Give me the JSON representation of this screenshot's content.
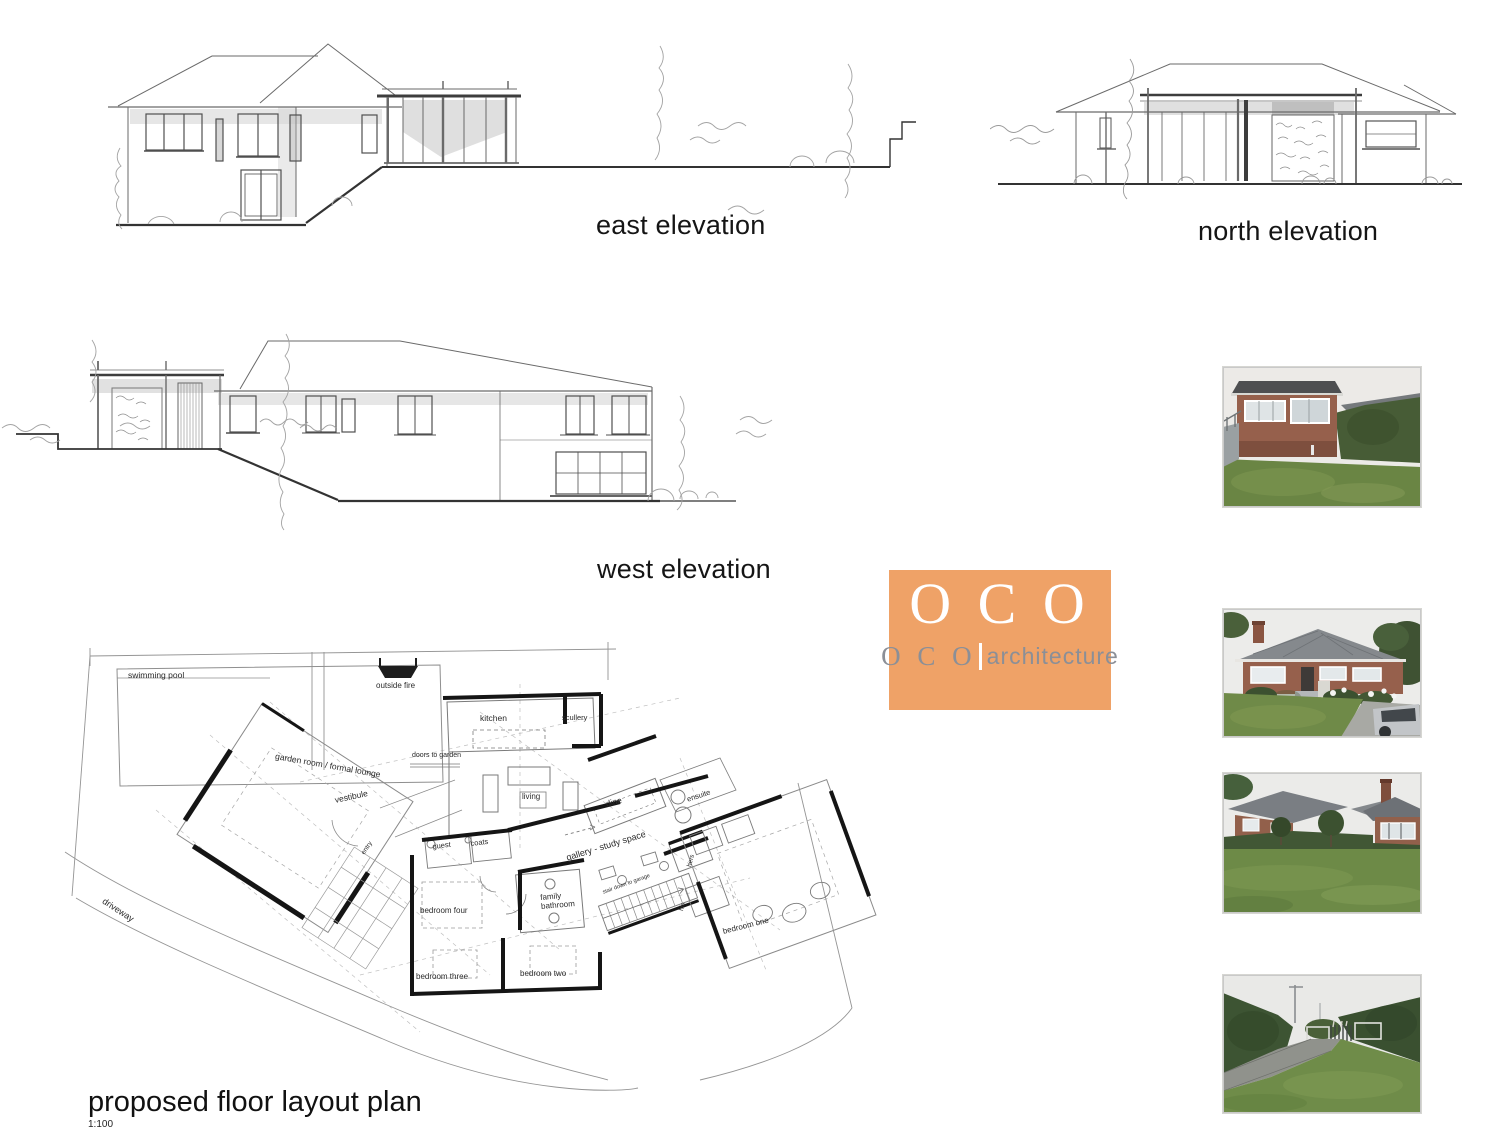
{
  "sheet": {
    "background": "#ffffff"
  },
  "elevations": {
    "east": "east elevation",
    "north": "north elevation",
    "west": "west elevation"
  },
  "logo": {
    "main": "O C O",
    "sub_initials": "O C O",
    "sub_word": "architecture",
    "orange": "#efa267",
    "text_gray": "#8b8f97"
  },
  "plan": {
    "title": "proposed floor layout plan",
    "scale": "1:100",
    "labels": {
      "swimming_pool": "swimming pool",
      "outside_fire": "outside fire",
      "kitchen": "kitchen",
      "scullery": "scullery",
      "garden_room": "garden room / formal lounge",
      "doors_to_garden": "doors to garden",
      "living": "living",
      "dine": "dine",
      "ensuite": "ensuite",
      "vestibule": "vestibule",
      "entry": "entry",
      "guest": "guest",
      "coats": "coats",
      "gallery": "gallery - study space",
      "hers": "hers",
      "his": "his",
      "family_bathroom": "family bathroom",
      "stair_down": "stair down to garage",
      "bedroom_one": "bedroom one",
      "bedroom_two": "bedroom two",
      "bedroom_three": "bedroom three",
      "bedroom_four": "bedroom four",
      "driveway": "driveway"
    }
  }
}
